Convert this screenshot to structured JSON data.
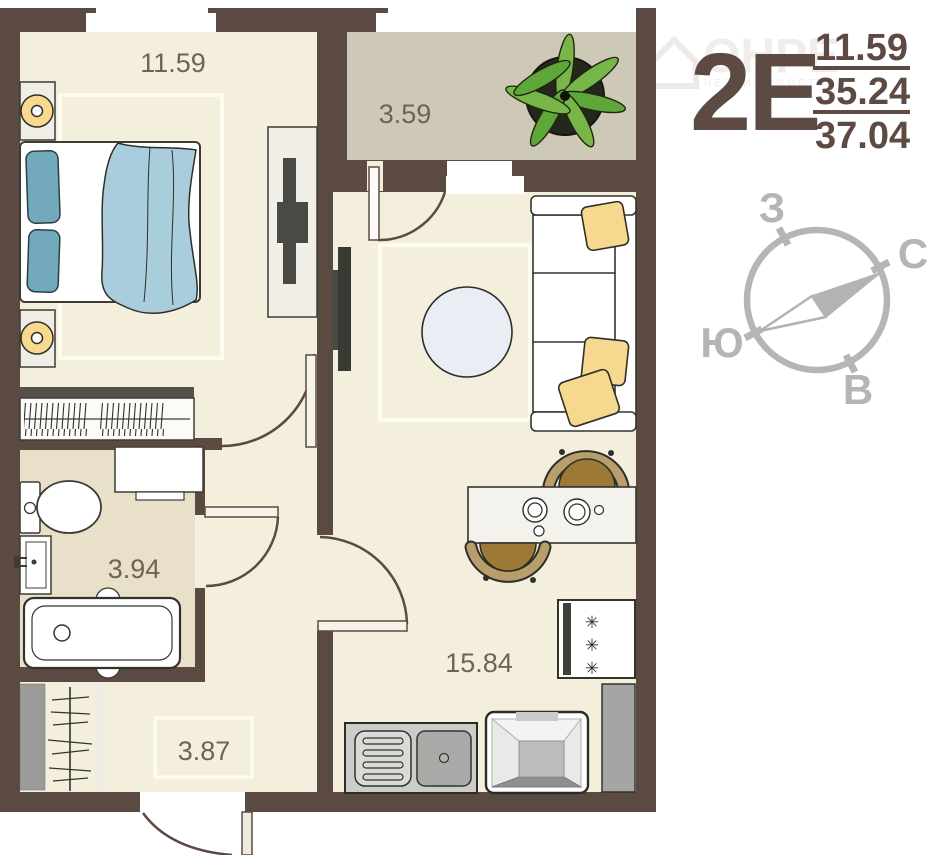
{
  "unit": {
    "type_label": "2Е",
    "area_living": "11.59",
    "area_mid": "35.24",
    "area_total": "37.04"
  },
  "rooms": {
    "bedroom": "11.59",
    "balcony": "3.59",
    "bathroom": "3.94",
    "kitchen_living": "15.84",
    "hallway": "3.87"
  },
  "compass": {
    "west": "З",
    "north": "С",
    "south": "Ю",
    "east": "В"
  },
  "fridge": {
    "symbol": "✳"
  },
  "watermark": {
    "brand": "ОНРЕ",
    "subtitle": "НЕДВИЖИМОСТЬ"
  },
  "colors": {
    "wall": "#5a4a42",
    "floor": "#f4efdd",
    "balcony_floor": "#cec8b6",
    "bathroom_floor": "#e9e0ca",
    "label_text": "#6f6359",
    "unit_text": "#5d4b43",
    "compass": "#b5b5b5",
    "pillow_blue": "#73aabb",
    "blanket_blue": "#a9cddd",
    "cushion_yellow": "#f6d88e",
    "chair_brown": "#9c7a35",
    "plant_green": "#79b64a",
    "lamp_yellow": "#f8da8e"
  }
}
